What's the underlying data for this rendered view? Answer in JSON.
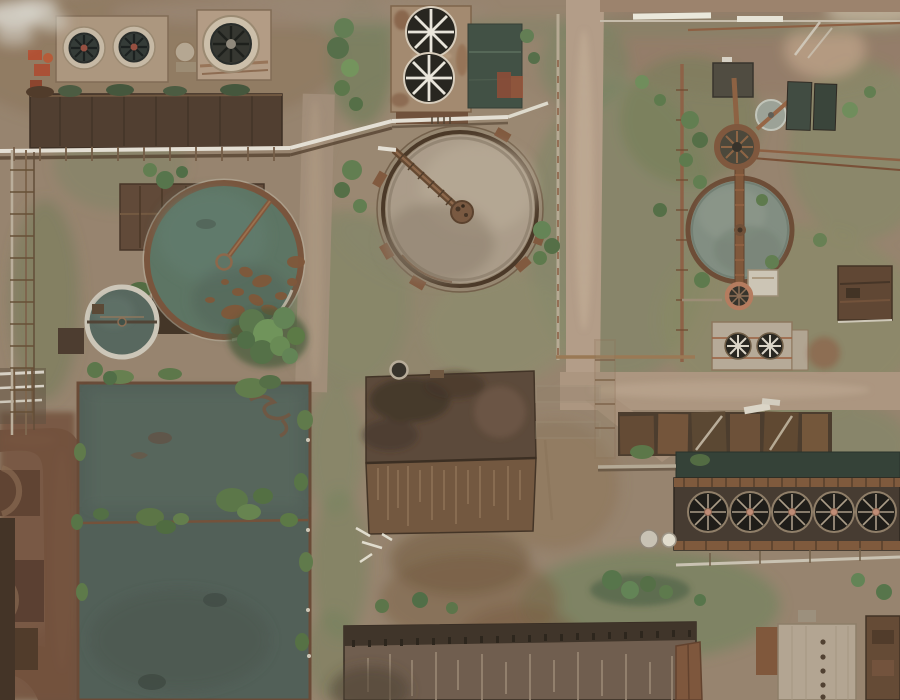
{
  "meta": {
    "title": "Aerial drone photograph of an abandoned industrial water treatment plant",
    "type": "aerial-photo",
    "width_px": 900,
    "height_px": 700
  },
  "palette": {
    "ground": "#94806b",
    "ground_light": "#a8937d",
    "road_tan": "#b29b85",
    "road_dark": "#6b4c39",
    "pond_water": "#4b5a52",
    "clarifier_left_water": "#57705f",
    "clarifier_center_water": "#a99a87",
    "clarifier_right_water": "#7e8b7f",
    "basin_dark": "#3a4a3e",
    "channel_dark": "#2c3a30",
    "rust": "#7c5134",
    "rust_dark": "#4a3729",
    "roof_brown": "#5b4231",
    "roof_lower": "#6e5139",
    "roof_gray": "#6b5849",
    "roof_ridge": "#382c21",
    "metal_white": "#e6e1d6",
    "vegetation": "#5d7a4e",
    "grass": "#7f8763",
    "fan_dark": "#1e1c17",
    "fan_blade_white": "#eae6dc",
    "fan_hub_red": "#93493a",
    "smoke": "#d7d3ca",
    "panel_white_roof": "#b2a390"
  },
  "scene": {
    "description": "Top-down aerial view of a rusted, partly overgrown industrial plant: cooling-tower blocks with large axial fans (top-left and top-center), a central clarifier tank with muddy tan water and a radial bridge, a dark teal clarifier at left with floating rust-colored scum, a small white-rimmed clarifier, a large rectangular settling pond with a shrub-covered divider at bottom-left, rusted corrugated-roof buildings at center and bottom, a long bank of five cooling fans at bottom-right, a smaller gray-green clarifier with vertical bridge at right, white overhead pipe bridges, tan dirt roads, green scrub, and steam at the top-left corner.",
    "features": [
      {
        "name": "cooling-tower-block-topleft",
        "kind": "building",
        "fans": 3
      },
      {
        "name": "dark-process-building-topleft",
        "kind": "building"
      },
      {
        "name": "steam-plume",
        "kind": "atmosphere"
      },
      {
        "name": "cooling-tower-topcenter",
        "kind": "building",
        "fans": 2
      },
      {
        "name": "dark-water-basin",
        "kind": "water"
      },
      {
        "name": "central-clarifier-tank",
        "kind": "tank",
        "water": "muddy tan",
        "bridge": "radial from northwest"
      },
      {
        "name": "left-clarifier-tank",
        "kind": "tank",
        "water": "dark teal",
        "scum": "rust patches"
      },
      {
        "name": "small-clarifier-tank",
        "kind": "tank",
        "rim": "white"
      },
      {
        "name": "settling-pond",
        "kind": "water",
        "divider": "shrub-covered"
      },
      {
        "name": "gabled-roof-building-left",
        "kind": "building"
      },
      {
        "name": "process-building-center",
        "kind": "building",
        "roof": "rusted corrugated"
      },
      {
        "name": "warehouse-bottom",
        "kind": "building",
        "roof": "gray corrugated with ridge"
      },
      {
        "name": "cooling-fan-bank-right",
        "kind": "building",
        "fans": 5
      },
      {
        "name": "right-clarifier-tank",
        "kind": "tank",
        "water": "gray green",
        "bridge": "vertical"
      },
      {
        "name": "small-thickener-tank",
        "kind": "tank"
      },
      {
        "name": "small-gray-tank",
        "kind": "tank"
      },
      {
        "name": "white-pipe-bridge",
        "kind": "piping"
      },
      {
        "name": "pipe-racks",
        "kind": "piping"
      },
      {
        "name": "dirt-roads",
        "kind": "road"
      },
      {
        "name": "vegetation",
        "kind": "nature"
      }
    ]
  }
}
